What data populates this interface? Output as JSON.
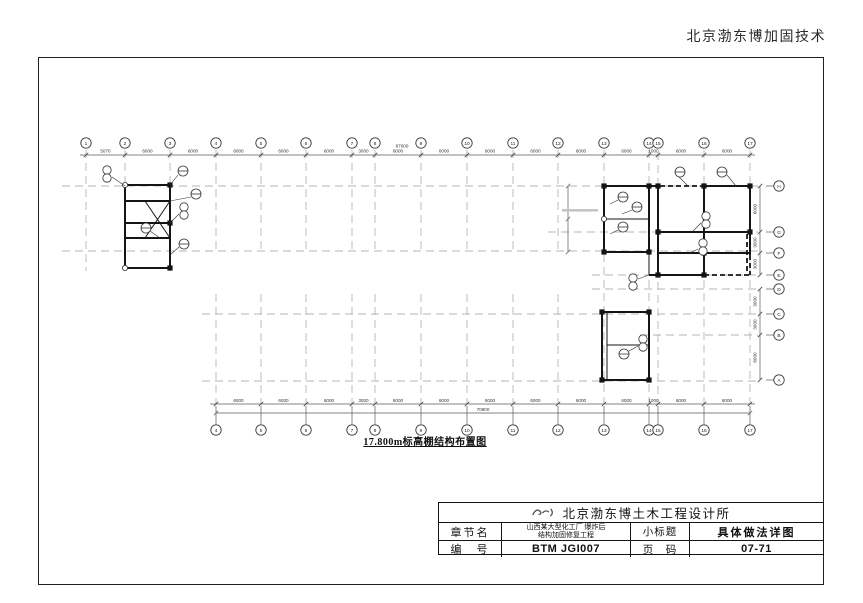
{
  "page": {
    "header_right": "北京渤东博加固技术"
  },
  "drawing": {
    "title": "17.800m标高棚结构布置图",
    "top_axis": {
      "labels": [
        "1",
        "2",
        "3",
        "4",
        "5",
        "6",
        "7",
        "8",
        "9",
        "10",
        "11",
        "12",
        "13",
        "14",
        "15",
        "16",
        "17"
      ],
      "dims": [
        "5070",
        "6000",
        "6000",
        "6000",
        "6000",
        "6000",
        "3000",
        "6000",
        "6000",
        "6000",
        "6000",
        "6000",
        "6000",
        "1000",
        "6000",
        "6000"
      ],
      "overall": "87000"
    },
    "bottom_axis": {
      "labels": [
        "4",
        "5",
        "6",
        "7",
        "8",
        "9",
        "10",
        "11",
        "12",
        "13",
        "14",
        "15",
        "16",
        "17"
      ],
      "dims": [
        "6000",
        "6000",
        "6000",
        "3000",
        "6000",
        "6000",
        "6000",
        "6000",
        "6000",
        "6000",
        "1000",
        "6000",
        "6000"
      ],
      "overall": "70800"
    },
    "right_axis": {
      "upper_labels": [
        "H",
        "G",
        "F",
        "E"
      ],
      "upper_dims": [
        "6000",
        "3000",
        "3000"
      ],
      "lower_labels": [
        "D",
        "C",
        "B",
        "A"
      ],
      "lower_dims": [
        "3000",
        "3000",
        "6000"
      ]
    }
  },
  "title_block": {
    "company": "北京渤东博土木工程设计所",
    "chapter_label": "章节名",
    "chapter_value_line1": "山西某大型化工厂 爆炸后",
    "chapter_value_line2": "结构加固修复工程",
    "subtitle_label": "小标题",
    "subtitle_value": "具体做法详图",
    "number_label": "编　号",
    "number_value": "BTM JGI007",
    "page_label": "页　码",
    "page_value": "07-71"
  },
  "icons": {
    "logo": "design-institute-calligraphy-mark"
  }
}
